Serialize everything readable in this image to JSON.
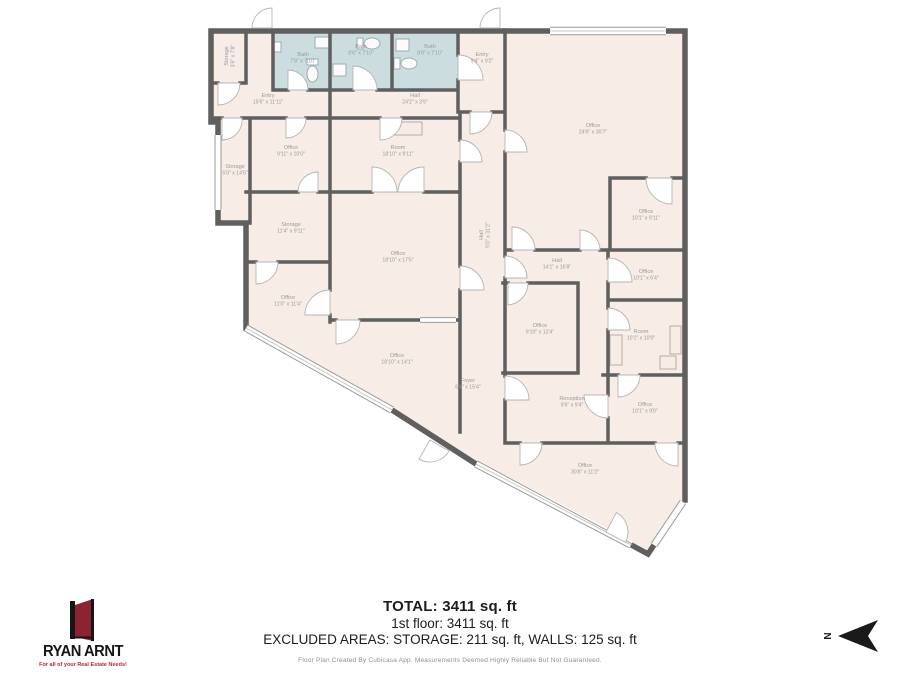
{
  "page": {
    "background": "#ffffff"
  },
  "floorplan": {
    "colors": {
      "room_fill": "#f7ece6",
      "bath_fill": "#ccdde0",
      "wall": "#5f5f5f",
      "label": "#9b9b9b",
      "fixture": "#98aeb4",
      "window_edge": "#9a9a9a"
    },
    "rooms": [
      {
        "name": "Storage",
        "dims": "3'6\" x 7'8\"",
        "x": 228,
        "y": 56,
        "rot": -90
      },
      {
        "name": "Entry",
        "dims": "15'6\" x 11'11\"",
        "x": 268,
        "y": 97,
        "rot": 0
      },
      {
        "name": "Bath",
        "dims": "7'8\" x 7'10\"",
        "x": 303,
        "y": 56,
        "rot": 0
      },
      {
        "name": "Bath",
        "dims": "8'6\" x 7'10\"",
        "x": 361,
        "y": 48,
        "rot": 0
      },
      {
        "name": "Bath",
        "dims": "8'8\" x 7'10\"",
        "x": 430,
        "y": 48,
        "rot": 0
      },
      {
        "name": "Entry",
        "dims": "9'4\" x 9'2\"",
        "x": 482,
        "y": 56,
        "rot": 0
      },
      {
        "name": "Hall",
        "dims": "24'2\" x 3'9\"",
        "x": 415,
        "y": 97,
        "rot": 0
      },
      {
        "name": "Office",
        "dims": "24'6\" x 30'7\"",
        "x": 593,
        "y": 127,
        "rot": 0
      },
      {
        "name": "Office",
        "dims": "10'1\" x 9'11\"",
        "x": 646,
        "y": 213,
        "rot": 0
      },
      {
        "name": "Hall",
        "dims": "5'0\" x 31'2\"",
        "x": 483,
        "y": 235,
        "rot": -90
      },
      {
        "name": "Office",
        "dims": "9'11\" x 10'0\"",
        "x": 291,
        "y": 149,
        "rot": 0
      },
      {
        "name": "Room",
        "dims": "18'10\" x 9'11\"",
        "x": 398,
        "y": 149,
        "rot": 0
      },
      {
        "name": "Storage",
        "dims": "5'0\" x 14'5\"",
        "x": 235,
        "y": 168,
        "rot": 0
      },
      {
        "name": "Storage",
        "dims": "11'4\" x 9'11\"",
        "x": 291,
        "y": 226,
        "rot": 0
      },
      {
        "name": "Office",
        "dims": "18'10\" x 17'5\"",
        "x": 398,
        "y": 255,
        "rot": 0
      },
      {
        "name": "Office",
        "dims": "11'0\" x 11'4\"",
        "x": 288,
        "y": 299,
        "rot": 0
      },
      {
        "name": "Office",
        "dims": "18'10\" x 14'1\"",
        "x": 397,
        "y": 357,
        "rot": 0
      },
      {
        "name": "Foyer",
        "dims": "6'6\" x 15'4\"",
        "x": 468,
        "y": 382,
        "rot": 0
      },
      {
        "name": "Hall",
        "dims": "14'1\" x 16'8\"",
        "x": 557,
        "y": 262,
        "rot": 0
      },
      {
        "name": "Office",
        "dims": "10'1\" x 6'4\"",
        "x": 646,
        "y": 273,
        "rot": 0
      },
      {
        "name": "Office",
        "dims": "9'10\" x 12'4\"",
        "x": 540,
        "y": 327,
        "rot": 0
      },
      {
        "name": "Room",
        "dims": "10'1\" x 10'0\"",
        "x": 641,
        "y": 333,
        "rot": 0
      },
      {
        "name": "Reception",
        "dims": "9'6\" x 9'4\"",
        "x": 572,
        "y": 400,
        "rot": 0
      },
      {
        "name": "Office",
        "dims": "10'1\" x 9'0\"",
        "x": 645,
        "y": 406,
        "rot": 0
      },
      {
        "name": "Office",
        "dims": "30'8\" x 11'2\"",
        "x": 585,
        "y": 467,
        "rot": 0
      }
    ]
  },
  "footer": {
    "total": "TOTAL: 3411 sq. ft",
    "floor": "1st floor: 3411 sq. ft",
    "excluded": "EXCLUDED AREAS: STORAGE: 211 sq. ft, WALLS: 125 sq. ft",
    "disclaimer": "Floor Plan Created By Cubicasa App. Measurements Deemed Highly Reliable But Not Guaranteed."
  },
  "logo": {
    "name": "RYAN ARNT",
    "tagline": "For all of your Real Estate Needs!",
    "door_color": "#8b2332"
  },
  "compass": {
    "label": "N"
  }
}
